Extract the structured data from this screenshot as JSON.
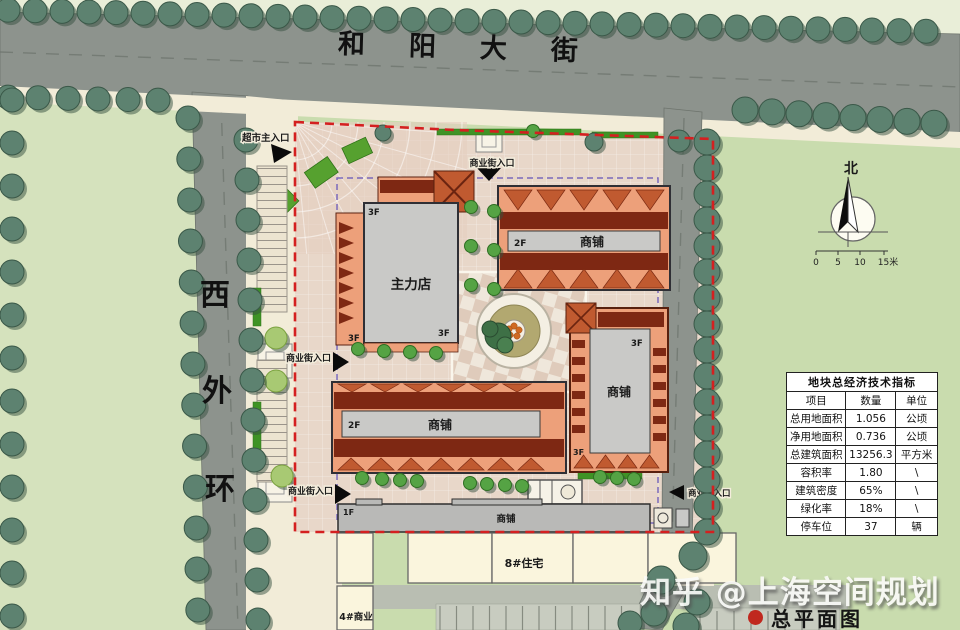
{
  "colors": {
    "grass_right": "#c9dcae",
    "grass_left": "#d5e2bd",
    "grass_pale": "#e9eed8",
    "road": "#8d938d",
    "road_line": "#6e746d",
    "sidewalk": "#f2ecd8",
    "paving": "#e8d7c9",
    "plaza_paving": "#e4cfc0",
    "salmon": "#eda07a",
    "dark_roof": "#7e2813",
    "roof_accent": "#c05a30",
    "gray_roof": "#c9c9c7",
    "outline": "#2f2f35",
    "boundary_red": "#d42020",
    "underground_purple": "#6656b8",
    "hedge_green": "#3f9325",
    "lawn_wedge": "#56a12f",
    "tree_street": "#5d8270",
    "tree_street_dark": "#3a5848",
    "tree_bright": "#55a344",
    "tree_light": "#a8c973",
    "residential_cream": "#faf5dd",
    "table_bg": "#ffffff",
    "caption_red": "#c0281e"
  },
  "roads": {
    "top_street": "和阳大街",
    "left_street_chars": [
      "西",
      "外",
      "环"
    ]
  },
  "compass": {
    "north_label": "北",
    "scale_labels": [
      "0",
      "5",
      "10",
      "15米"
    ]
  },
  "site": {
    "entrances": {
      "supermarket_main": "超市主入口",
      "commercial_street": "商业街入口"
    },
    "buildings": {
      "main_store": "主力店",
      "shop": "商铺",
      "residential_8": "8#住宅",
      "commercial_4": "4#商业"
    },
    "floors": {
      "f1": "1F",
      "f2": "2F",
      "f3": "3F"
    }
  },
  "indicators_table": {
    "title": "地块总经济技术指标",
    "headers": [
      "项目",
      "数量",
      "单位"
    ],
    "rows": [
      {
        "item": "总用地面积",
        "value": "1.056",
        "unit": "公顷"
      },
      {
        "item": "净用地面积",
        "value": "0.736",
        "unit": "公顷"
      },
      {
        "item": "总建筑面积",
        "value": "13256.3",
        "unit": "平方米"
      },
      {
        "item": "容积率",
        "value": "1.80",
        "unit": "\\"
      },
      {
        "item": "建筑密度",
        "value": "65%",
        "unit": "\\"
      },
      {
        "item": "绿化率",
        "value": "18%",
        "unit": "\\"
      },
      {
        "item": "停车位",
        "value": "37",
        "unit": "辆"
      }
    ]
  },
  "watermark": "知乎 @上海空间规划",
  "caption": {
    "label": "总平面图"
  }
}
